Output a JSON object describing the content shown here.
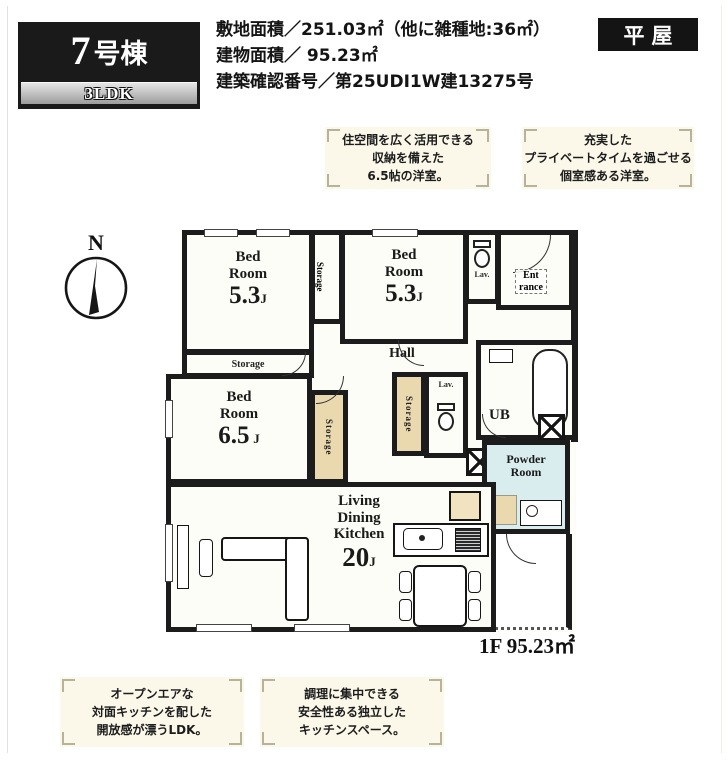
{
  "header": {
    "unit_number_big": "7",
    "unit_number_rest": "号棟",
    "plan_type": "3LDK",
    "badge": "平屋",
    "info_lines": [
      "敷地面積／251.03㎡（他に雑種地:36㎡）",
      "建物面積／ 95.23㎡",
      "建築確認番号／第25UDI1W建13275号"
    ]
  },
  "callouts": [
    {
      "lines": [
        "住空間を広く活用できる",
        "収納を備えた",
        "6.5帖の洋室。"
      ]
    },
    {
      "lines": [
        "充実した",
        "プライベートタイムを過ごせる",
        "個室感ある洋室。"
      ]
    },
    {
      "lines": [
        "オープンエアな",
        "対面キッチンを配した",
        "開放感が漂うLDK。"
      ]
    },
    {
      "lines": [
        "調理に集中できる",
        "安全性ある独立した",
        "キッチンスペース。"
      ]
    }
  ],
  "compass": {
    "north": "N"
  },
  "plan": {
    "rooms": {
      "bed": "Bed",
      "room": "Room",
      "bed1_size": "5.3",
      "bed2_size": "5.3",
      "bed3_size": "6.5",
      "size_unit": "J",
      "hall": "Hall",
      "ub": "UB",
      "lav": "Lav.",
      "storage": "Storage",
      "entrance_l1": "Ent",
      "entrance_l2": "rance",
      "powder_l1": "Powder",
      "powder_l2": "Room",
      "ldk_l1": "Living",
      "ldk_l2": "Dining",
      "ldk_l3": "Kitchen",
      "ldk_size": "20"
    },
    "floor_area": "1F 95.23㎡"
  },
  "colors": {
    "wall": "#1c1c1c",
    "storage_beige": "#ead9ae",
    "powder_blue": "#d9ecee",
    "callout_bg": "#fbf8ea"
  }
}
